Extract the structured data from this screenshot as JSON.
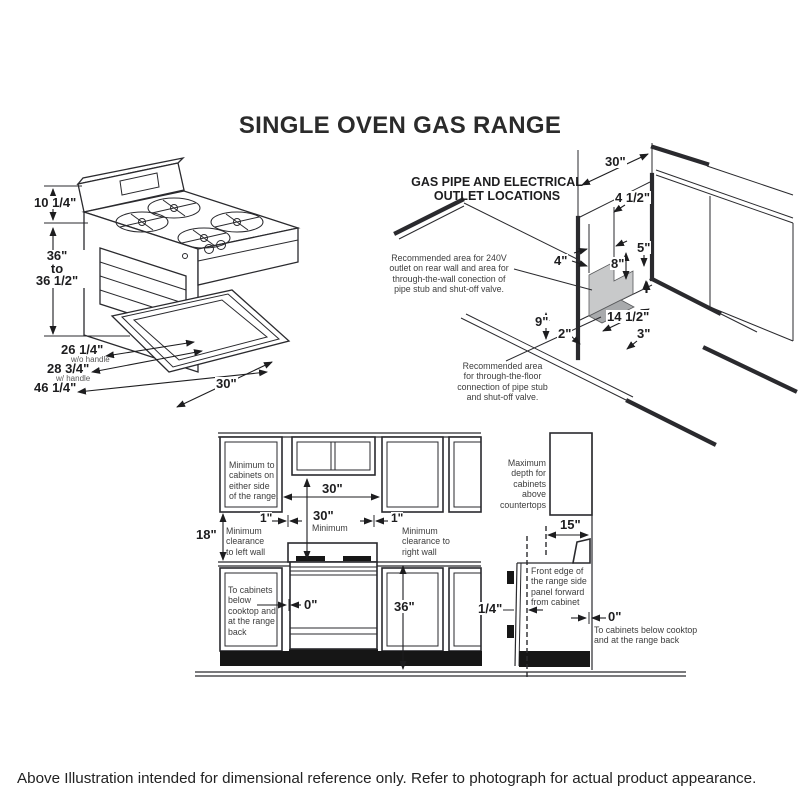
{
  "title": "SINGLE OVEN GAS RANGE",
  "footer": "Above Illustration intended for dimensional reference only. Refer to photograph for actual product appearance.",
  "range_iso": {
    "backsplash_height": "10 1/4\"",
    "range_height": "36\"\nto\n36 1/2\"",
    "depth_no_handle": "26 1/4\"",
    "depth_no_handle_note": "w/o handle",
    "depth_handle": "28 3/4\"",
    "depth_handle_note": "w/ handle",
    "depth_door_open": "46 1/4\"",
    "width": "30\""
  },
  "gas_pipe": {
    "heading": "GAS PIPE AND ELECTRICAL\nOUTLET LOCATIONS",
    "wall_note": "Recommended area for 240V\noutlet on rear wall and area for\nthrough-the-wall conection of\npipe stub and shut-off valve.",
    "floor_note": "Recommended area\nfor through-the-floor\nconnection of pipe stub\nand shut-off valve.",
    "alcove_width": "30\"",
    "outlet_offset": "4 1/2\"",
    "wall_left_offset": "4\"",
    "area_height_left": "8\"",
    "area_height_right": "5\"",
    "floor_height": "9\"",
    "floor_corner": "2\"",
    "floor_width": "14 1/2\"",
    "floor_depth": "3\""
  },
  "install_front": {
    "cabinet_note": "Minimum to\ncabinets on\neither side\nof the range.",
    "opening_width": "30\"",
    "min_height": "30\"",
    "min_height_note": "Minimum",
    "left_clearance": "1\"",
    "left_clearance_note": "Minimum\nclearance\nto left wall",
    "upper_cabinet_height": "18\"",
    "right_clearance": "1\"",
    "right_clearance_note": "Minimum\nclearance to\nright wall",
    "below_note": "To cabinets\nbelow\ncooktop and\nat the range\nback",
    "zero_clearance": "0\"",
    "counter_height": "36\""
  },
  "install_side": {
    "max_depth_note": "Maximum\ndepth for\ncabinets above\ncountertops",
    "cabinet_depth": "15\"",
    "front_edge_note": "Front edge of\nthe range side\npanel forward\nfrom cabinet",
    "panel_offset": "1/4\"",
    "zero_clearance": "0\"",
    "zero_note": "To cabinets below cooktop\nand at the range back"
  },
  "colors": {
    "line": "#2a2a2e",
    "shade": "#c8c9ca",
    "shade_dark": "#a8aaac"
  }
}
